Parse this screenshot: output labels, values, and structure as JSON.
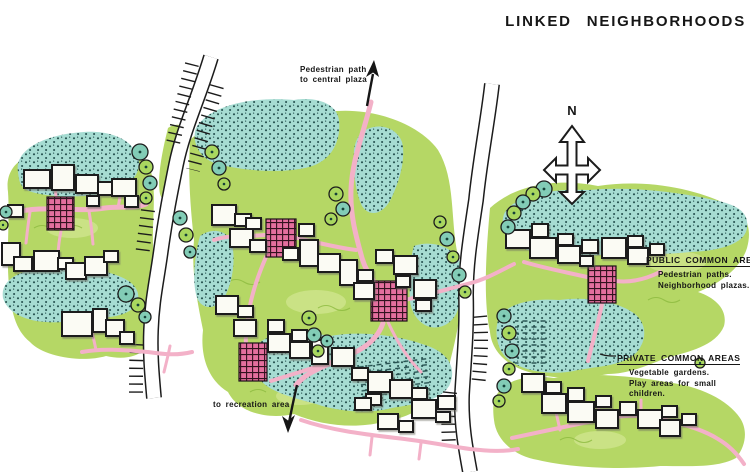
{
  "title": "LINKED  NEIGHBORHOODS",
  "compass": {
    "north_label": "N"
  },
  "annotations": {
    "pedestrian_path": {
      "line1": "Pedestrian path",
      "line2": "to central plaza"
    },
    "recreation": "to recreation area"
  },
  "legend": {
    "public": {
      "heading": "PUBLIC COMMON AREA",
      "items": [
        "Pedestrian paths.",
        "Neighborhood plazas."
      ]
    },
    "private": {
      "heading": "PRIVATE COMMON AREAS",
      "items": [
        "Vegetable gardens.",
        "Play areas for small",
        "children."
      ]
    }
  },
  "palette": {
    "paper": "#ffffff",
    "ink": "#1c1c1c",
    "teal_fill": "#a6dcd2",
    "teal_dot": "#24504e",
    "lawn": "#b5d765",
    "lawn_light": "#d6e896",
    "lawn_dark": "#8cba3f",
    "path_pink": "#f3b1c8",
    "plaza_pink": "#e46f9e",
    "tree_teal": "#82ccb6",
    "tree_green": "#a9d75f",
    "house_fill": "#fbfbf4"
  }
}
